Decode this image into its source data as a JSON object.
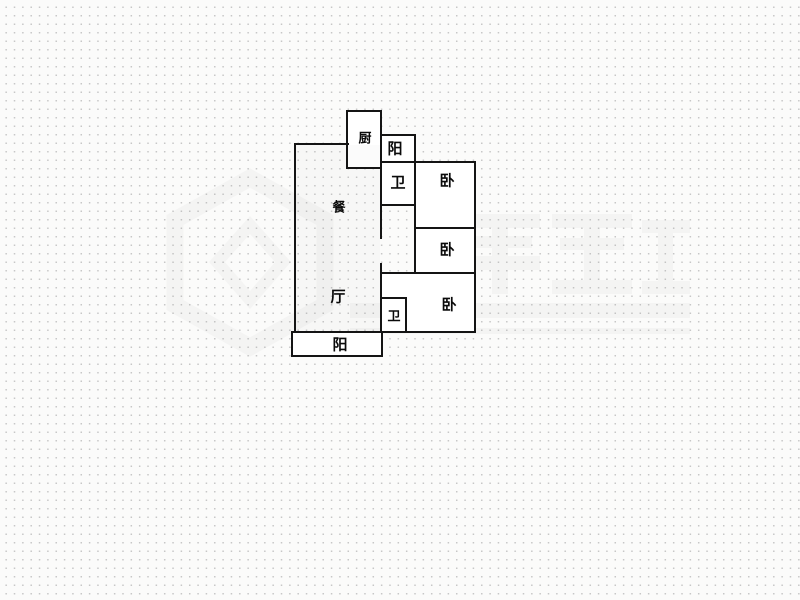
{
  "page": {
    "background_color": "#fbfbfa",
    "dot_color": "#c7c7c7",
    "wall_color": "#141414"
  },
  "floor_plan": {
    "rooms": [
      {
        "id": "kitchen",
        "label": "厨"
      },
      {
        "id": "balcony-top",
        "label": "阳"
      },
      {
        "id": "bathroom-top",
        "label": "卫"
      },
      {
        "id": "bedroom-top",
        "label": "卧"
      },
      {
        "id": "bedroom-middle",
        "label": "卧"
      },
      {
        "id": "bedroom-bottom",
        "label": "卧"
      },
      {
        "id": "bathroom-bottom",
        "label": "卫"
      },
      {
        "id": "dining",
        "label": "餐"
      },
      {
        "id": "living",
        "label": "厅"
      },
      {
        "id": "balcony-bottom",
        "label": "阳"
      }
    ]
  },
  "watermark": {
    "present": "true",
    "color": "#8a8a8a"
  }
}
